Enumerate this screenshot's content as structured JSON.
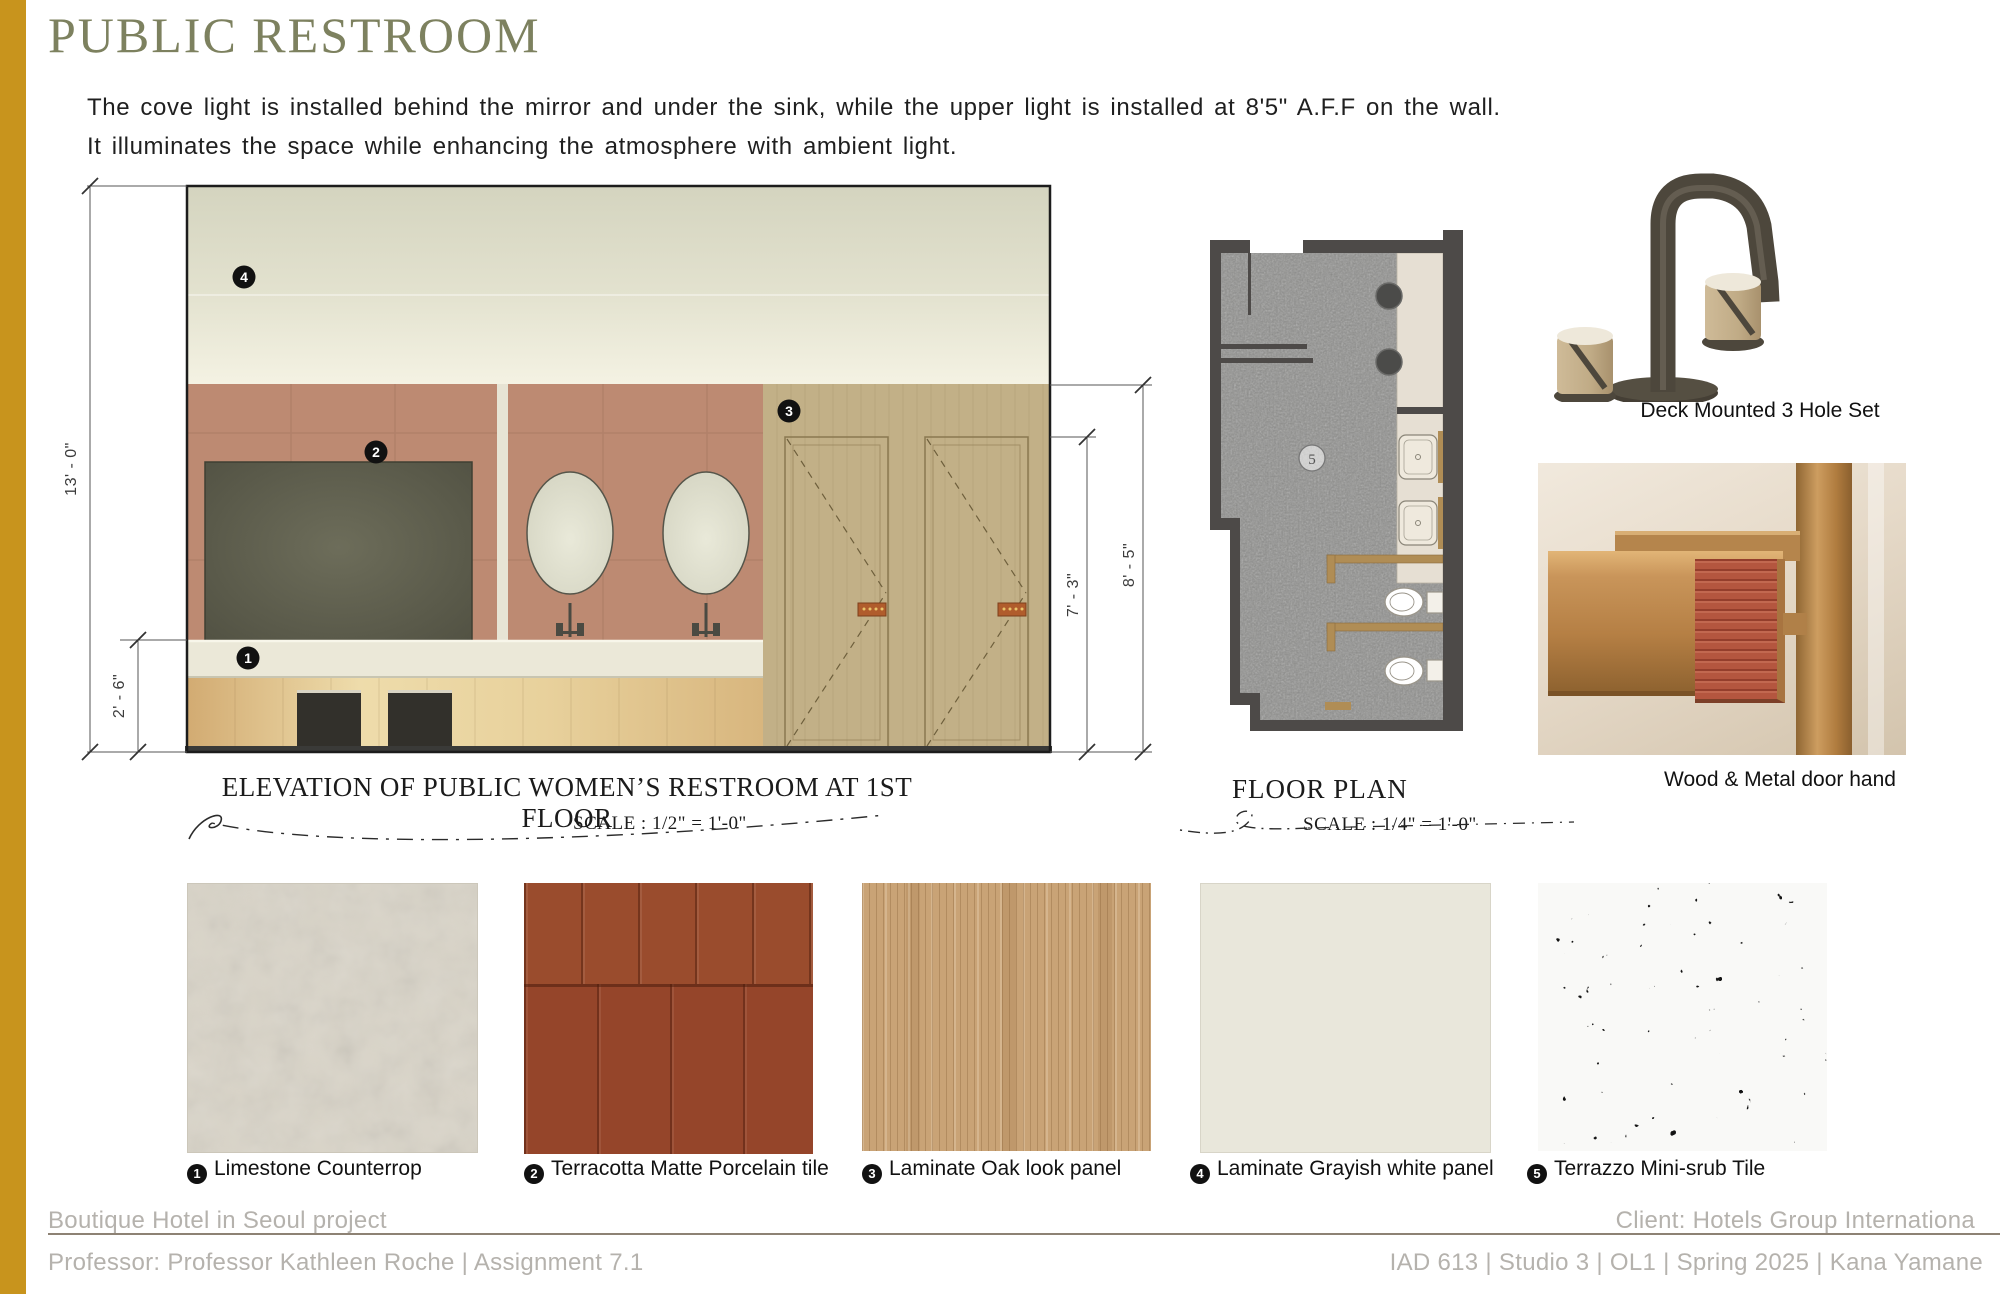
{
  "title": "PUBLIC RESTROOM",
  "description": {
    "line1": "The cove light is installed behind the mirror and under the sink, while the upper light is installed at 8'5\" A.F.F on the wall.",
    "line2": "It illuminates the space while enhancing the atmosphere with ambient light."
  },
  "elevation": {
    "caption": "ELEVATION OF PUBLIC WOMEN’S RESTROOM AT 1ST FLOOR",
    "scale_label": "SCALE : 1/2\" = 1'-0\"",
    "dims": {
      "total": "13' - 0\"",
      "counter": "2' - 6\"",
      "door": "7' - 3\"",
      "wall": "8' - 5\""
    },
    "markers": {
      "m1": "1",
      "m2": "2",
      "m3": "3",
      "m4": "4"
    }
  },
  "floor_plan": {
    "caption": "FLOOR PLAN",
    "scale_label": "SCALE : 1/4\" = 1'-0\"",
    "room_marker": "5"
  },
  "products": {
    "faucet_label": "Deck Mounted 3 Hole Set",
    "handle_label": "Wood & Metal door hand"
  },
  "materials": [
    {
      "num": "1",
      "label": "Limestone Counterrop"
    },
    {
      "num": "2",
      "label": "Terracotta Matte Porcelain tile"
    },
    {
      "num": "3",
      "label": "Laminate Oak look panel"
    },
    {
      "num": "4",
      "label": "Laminate Grayish white panel"
    },
    {
      "num": "5",
      "label": "Terrazzo Mini-srub Tile"
    }
  ],
  "footer": {
    "project": "Boutique Hotel in Seoul project",
    "client": "Client: Hotels Group Internationa",
    "professor": "Professor: Professor Kathleen Roche | Assignment 7.1",
    "course": "IAD 613 | Studio 3 | OL1 | Spring 2025 | Kana Yamane"
  },
  "palette": {
    "gold_bar": "#C8941D",
    "title_olive": "#7D815F",
    "terracotta_wall": "#BD8A72",
    "terracotta_tile": "#9A4C2D",
    "counter_cream": "#EBE8D8",
    "door_tan": "#C2B087",
    "plan_wall_gray": "#4D4A48",
    "footer_gray": "#B5B2AD"
  }
}
